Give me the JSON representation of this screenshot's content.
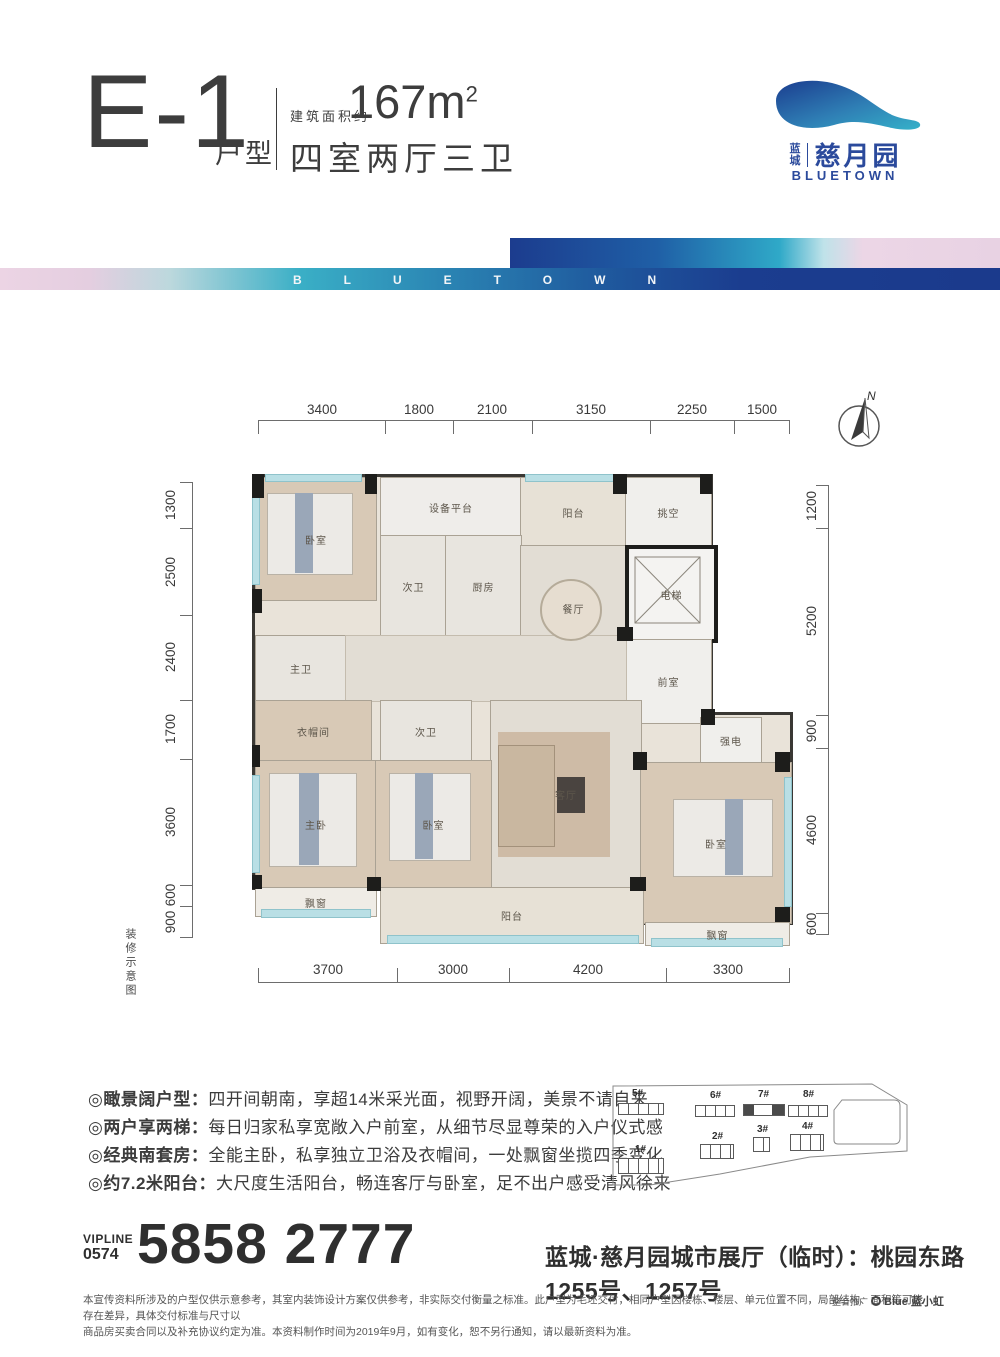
{
  "header": {
    "unit_code": "E-1",
    "unit_suffix": "户型",
    "area_label": "建筑面积约",
    "area_value": "167m",
    "area_sup": "2",
    "layout_desc": "四室两厅三卫"
  },
  "logo": {
    "brand_cn": "蓝城",
    "project_name": "慈月园",
    "brand_en": "BLUETOWN",
    "accent_navy": "#1b3d8f",
    "accent_teal": "#2fa9c8",
    "accent_pink": "#ecd6e6",
    "logo_blue": "#2b4a9c"
  },
  "band": {
    "letters": "BLUETOWN"
  },
  "compass": {
    "north_label": "N"
  },
  "plan_note": "装修示意图",
  "dimensions": {
    "top": [
      "3400",
      "1800",
      "2100",
      "3150",
      "2250",
      "1500"
    ],
    "bottom": [
      "3700",
      "3000",
      "4200",
      "3300"
    ],
    "left": [
      "1300",
      "2500",
      "2400",
      "1700",
      "3600",
      "600",
      "900"
    ],
    "right": [
      "1200",
      "5200",
      "900",
      "4600",
      "600"
    ]
  },
  "rooms": [
    {
      "id": "bedroom-northwest",
      "label": "卧室"
    },
    {
      "id": "equipment-platform",
      "label": "设备平台"
    },
    {
      "id": "balcony-north",
      "label": "阳台"
    },
    {
      "id": "void",
      "label": "挑空"
    },
    {
      "id": "bathroom-second-upper",
      "label": "次卫"
    },
    {
      "id": "kitchen",
      "label": "厨房"
    },
    {
      "id": "dining-room",
      "label": "餐厅"
    },
    {
      "id": "elevator",
      "label": "电梯"
    },
    {
      "id": "master-bathroom",
      "label": "主卫"
    },
    {
      "id": "anteroom",
      "label": "前室"
    },
    {
      "id": "cloakroom",
      "label": "衣帽间"
    },
    {
      "id": "bathroom-second-lower",
      "label": "次卫"
    },
    {
      "id": "electric-room",
      "label": "强电"
    },
    {
      "id": "living-room",
      "label": "客厅"
    },
    {
      "id": "master-bedroom",
      "label": "主卧"
    },
    {
      "id": "bedroom-middle",
      "label": "卧室"
    },
    {
      "id": "bedroom-east",
      "label": "卧室"
    },
    {
      "id": "bay-window-west",
      "label": "飘窗"
    },
    {
      "id": "balcony-south",
      "label": "阳台"
    },
    {
      "id": "bay-window-east",
      "label": "飘窗"
    }
  ],
  "features": [
    {
      "title": "◎瞰景阔户型：",
      "desc": "四开间朝南，享超14米采光面，视野开阔，美景不请自来"
    },
    {
      "title": "◎两户享两梯：",
      "desc": "每日归家私享宽敞入户前室，从细节尽显尊荣的入户仪式感"
    },
    {
      "title": "◎经典南套房：",
      "desc": "全能主卧，私享独立卫浴及衣帽间，一处飘窗坐揽四季变化"
    },
    {
      "title": "◎约7.2米阳台：",
      "desc": "大尺度生活阳台，畅连客厅与卧室，足不出户感受清风徐来"
    }
  ],
  "sitemap": {
    "buildings": [
      {
        "label": "5#"
      },
      {
        "label": "6#"
      },
      {
        "label": "7#",
        "highlighted": true
      },
      {
        "label": "8#"
      },
      {
        "label": "1#"
      },
      {
        "label": "2#"
      },
      {
        "label": "3#"
      },
      {
        "label": "4#"
      }
    ]
  },
  "hotline": {
    "vipline_label": "VIPLINE",
    "area_code": "0574",
    "number": "5858 2777",
    "address": "蓝城·慈月园城市展厅（临时）：桃园东路1255号、1257号"
  },
  "disclaimer": {
    "line1": "本宣传资料所涉及的户型仅供示意参考，其室内装饰设计方案仅供参考，非实际交付衡量之标准。此户型为毛坯交付，相同户型因楼栋、楼层、单元位置不同，局部结构、面积等可能存在差异，具体交付标准与尺寸以",
    "line2": "商品房买卖合同以及补充协议约定为准。本资料制作时间为2019年9月，如有变化，恕不另行通知，请以最新资料为准。",
    "promo_label": "整合推广",
    "promo_brand": "Blue 蓝小虹"
  }
}
